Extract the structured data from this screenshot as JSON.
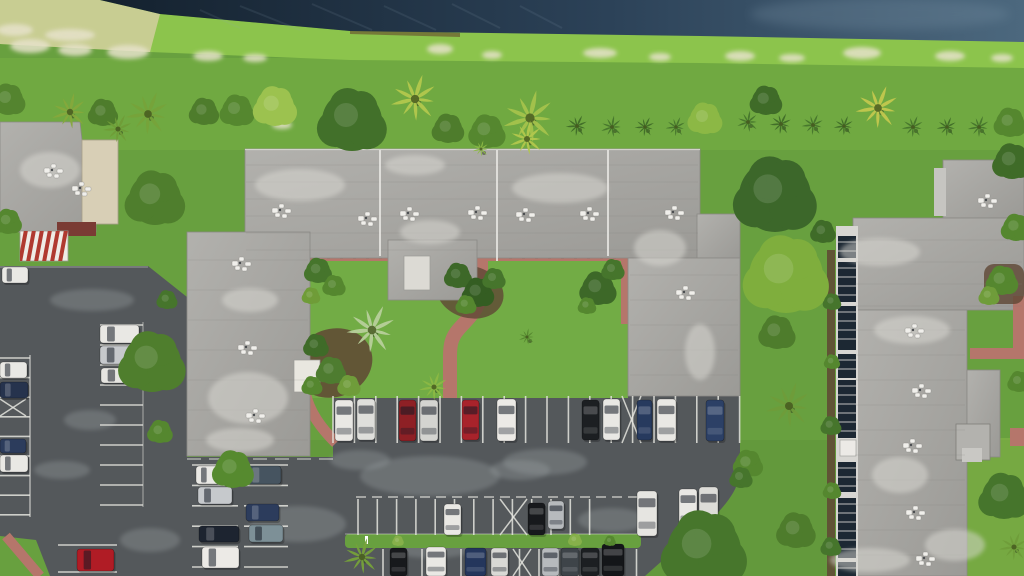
{
  "meta": {
    "description": "Aerial drone view of a condominium complex: flat gray roofs around a landscaped central courtyard with salmon-red concrete walkways, parking lots with parked cars, mowed lawns with rows of palms and shrubs, a bright grassy canal bank and a dark blue-gray canal across the top."
  },
  "palette": {
    "grass": "#68a03f",
    "grass_bright": "#8cc44c",
    "grass_dark": "#4e7c30",
    "grass_pale": "#c8cd92",
    "sand": "#e6e2ca",
    "water_dark": "#14212e",
    "water_mid": "#2c4258",
    "water_light": "#4c687e",
    "roof": "#a8a7a3",
    "roof_light": "#c6c5c1",
    "roof_edge": "#878682",
    "beige_roof": "#d8cfb6",
    "maroon": "#7a3b34",
    "awning_white": "#efece6",
    "awning_red": "#b03a30",
    "asphalt": "#54585b",
    "asphalt_light": "#9aa0a2",
    "stall_line": "#e4e4de",
    "path_red": "#b5766b",
    "mulch": "#5f4734",
    "glass": "#1c2833",
    "walk_white": "#d7d6d2",
    "white_unit": "#f0efeb"
  },
  "water_streaks": [
    [
      240,
      6,
      300,
      30
    ],
    [
      312,
      4,
      372,
      30
    ],
    [
      384,
      6,
      436,
      30
    ],
    [
      452,
      4,
      500,
      28
    ],
    [
      520,
      6,
      562,
      28
    ],
    [
      200,
      10,
      240,
      28
    ]
  ],
  "sand": [
    [
      30,
      46,
      20,
      7
    ],
    [
      75,
      50,
      17,
      6
    ],
    [
      128,
      52,
      21,
      7
    ],
    [
      208,
      56,
      15,
      5
    ],
    [
      255,
      58,
      12,
      4
    ],
    [
      440,
      49,
      13,
      5
    ],
    [
      492,
      55,
      10,
      4
    ],
    [
      600,
      53,
      17,
      5
    ],
    [
      660,
      57,
      11,
      4
    ],
    [
      740,
      56,
      15,
      5
    ],
    [
      792,
      58,
      13,
      4
    ],
    [
      862,
      53,
      19,
      6
    ],
    [
      950,
      56,
      15,
      5
    ],
    [
      1002,
      58,
      11,
      4
    ],
    [
      282,
      125,
      10,
      4
    ],
    [
      70,
      35,
      25,
      6
    ],
    [
      15,
      30,
      18,
      6
    ]
  ],
  "roof_patches": [
    [
      300,
      185,
      45,
      16
    ],
    [
      560,
      188,
      48,
      15
    ],
    [
      430,
      232,
      30,
      12
    ],
    [
      660,
      248,
      26,
      18
    ],
    [
      250,
      300,
      28,
      12
    ],
    [
      248,
      398,
      40,
      26
    ],
    [
      240,
      440,
      34,
      12
    ],
    [
      700,
      352,
      15,
      28
    ],
    [
      415,
      165,
      30,
      10
    ],
    [
      880,
      252,
      40,
      14
    ],
    [
      900,
      475,
      28,
      18
    ],
    [
      912,
      330,
      38,
      14
    ],
    [
      955,
      545,
      30,
      16
    ],
    [
      50,
      170,
      30,
      18
    ],
    [
      870,
      560,
      40,
      12
    ]
  ],
  "asphalt_patches": [
    [
      430,
      476,
      70,
      20
    ],
    [
      545,
      462,
      42,
      13
    ],
    [
      298,
      524,
      48,
      18
    ],
    [
      612,
      520,
      34,
      12
    ],
    [
      245,
      308,
      24,
      9
    ],
    [
      92,
      300,
      42,
      11
    ],
    [
      62,
      470,
      28,
      9
    ],
    [
      432,
      549,
      40,
      9
    ],
    [
      520,
      470,
      30,
      10
    ],
    [
      360,
      460,
      30,
      10
    ],
    [
      150,
      540,
      30,
      12
    ],
    [
      90,
      420,
      26,
      10
    ]
  ],
  "ac_units": [
    [
      272,
      208
    ],
    [
      358,
      216
    ],
    [
      400,
      211
    ],
    [
      468,
      210
    ],
    [
      516,
      212
    ],
    [
      580,
      211
    ],
    [
      665,
      210
    ],
    [
      232,
      261
    ],
    [
      238,
      345
    ],
    [
      246,
      413
    ],
    [
      676,
      290
    ],
    [
      905,
      328
    ],
    [
      912,
      388
    ],
    [
      903,
      443
    ],
    [
      906,
      510
    ],
    [
      978,
      198
    ],
    [
      916,
      556
    ],
    [
      44,
      168
    ],
    [
      72,
      186
    ]
  ],
  "pipes": [
    [
      380,
      150,
      380,
      256
    ],
    [
      497,
      150,
      497,
      261
    ],
    [
      608,
      150,
      608,
      256
    ]
  ],
  "stall_groups": [
    {
      "d": "v",
      "x": 333,
      "y": 396,
      "len": 47,
      "n": 20,
      "g": 21.4
    },
    {
      "d": "v",
      "x": 358,
      "y": 499,
      "len": 36,
      "n": 13,
      "g": 19.3
    },
    {
      "d": "v",
      "x": 383,
      "y": 549,
      "len": 27,
      "n": 14,
      "g": 19.5
    },
    {
      "d": "h",
      "x": 0,
      "len": 30,
      "y": 358,
      "n": 9,
      "g": 19.6
    },
    {
      "d": "h",
      "x": 100,
      "len": 43,
      "y": 325,
      "n": 10,
      "g": 20
    },
    {
      "d": "h",
      "x": 192,
      "len": 46,
      "y": 465,
      "n": 6,
      "g": 20.4
    },
    {
      "d": "h",
      "x": 244,
      "len": 44,
      "y": 465,
      "n": 6,
      "g": 20.4
    },
    {
      "d": "h",
      "x": 58,
      "len": 59,
      "y": 545,
      "n": 2,
      "g": 27
    }
  ],
  "dash_lines": [
    {
      "x1": 356,
      "y1": 497,
      "x2": 640,
      "y2": 497,
      "dash": "10 6",
      "w": 1.5,
      "o": 0.75
    },
    {
      "x1": 187,
      "y1": 459,
      "x2": 333,
      "y2": 459,
      "dash": "14 8",
      "w": 1.5,
      "o": 0.6
    },
    {
      "x1": 345,
      "y1": 534,
      "x2": 641,
      "y2": 534,
      "dash": "",
      "w": 1,
      "o": 0.5
    },
    {
      "x1": 30,
      "y1": 355,
      "x2": 30,
      "y2": 517,
      "dash": "",
      "w": 1.4,
      "o": 0.7
    },
    {
      "x1": 143,
      "y1": 322,
      "x2": 143,
      "y2": 507,
      "dash": "",
      "w": 1.2,
      "o": 0.5
    },
    {
      "x1": 0,
      "y1": 267,
      "x2": 148,
      "y2": 267,
      "dash": "",
      "w": 1.2,
      "o": 0.4
    }
  ],
  "x_stalls": [
    [
      622,
      396,
      19,
      47
    ],
    [
      500,
      499,
      27,
      36
    ],
    [
      513,
      549,
      18,
      27
    ],
    [
      0,
      399,
      26,
      17
    ]
  ],
  "glass_segments": [
    [
      236,
      22
    ],
    [
      262,
      40
    ],
    [
      306,
      44
    ],
    [
      354,
      24
    ],
    [
      380,
      58
    ],
    [
      462,
      30
    ],
    [
      498,
      60
    ],
    [
      562,
      14
    ]
  ],
  "cars": [
    [
      335,
      400,
      18,
      41,
      "#e9e8e4"
    ],
    [
      357,
      399,
      18,
      41,
      "#dfdfdb"
    ],
    [
      399,
      400,
      17,
      41,
      "#8e2025"
    ],
    [
      420,
      400,
      18,
      41,
      "#d4d4d0"
    ],
    [
      462,
      400,
      17,
      40,
      "#a8232b"
    ],
    [
      497,
      399,
      19,
      42,
      "#eceae6"
    ],
    [
      582,
      400,
      17,
      40,
      "#1c1f22"
    ],
    [
      603,
      399,
      17,
      41,
      "#e9e8e4"
    ],
    [
      637,
      400,
      15,
      40,
      "#273a5e"
    ],
    [
      657,
      399,
      19,
      42,
      "#e9e8e4"
    ],
    [
      706,
      400,
      18,
      41,
      "#2c4066"
    ],
    [
      444,
      504,
      17,
      31,
      "#e9e8e4"
    ],
    [
      528,
      503,
      17,
      32,
      "#17191c"
    ],
    [
      548,
      501,
      16,
      28,
      "#b7babd"
    ],
    [
      637,
      491,
      20,
      45,
      "#e6e5e1"
    ],
    [
      679,
      489,
      18,
      39,
      "#e9e8e4"
    ],
    [
      699,
      487,
      19,
      43,
      "#dddcd8"
    ],
    [
      390,
      548,
      17,
      28,
      "#17191c"
    ],
    [
      426,
      547,
      20,
      29,
      "#e9e8e4"
    ],
    [
      465,
      548,
      21,
      28,
      "#24365c"
    ],
    [
      491,
      548,
      17,
      28,
      "#d9d9d5"
    ],
    [
      542,
      548,
      17,
      28,
      "#b7babd"
    ],
    [
      561,
      548,
      18,
      28,
      "#3e4449"
    ],
    [
      581,
      548,
      18,
      28,
      "#1c1f22"
    ],
    [
      602,
      544,
      22,
      32,
      "#141619"
    ],
    [
      0,
      362,
      27,
      16,
      "#e9e8e4"
    ],
    [
      0,
      382,
      28,
      16,
      "#26334d"
    ],
    [
      0,
      439,
      26,
      14,
      "#2c3c5c"
    ],
    [
      0,
      455,
      28,
      17,
      "#e9e8e4"
    ],
    [
      100,
      325,
      39,
      18,
      "#e9e8e4"
    ],
    [
      100,
      346,
      38,
      18,
      "#c6c9cc"
    ],
    [
      101,
      368,
      37,
      15,
      "#e6e5e1"
    ],
    [
      2,
      267,
      26,
      16,
      "#e9e8e4"
    ],
    [
      196,
      466,
      28,
      18,
      "#e9e8e4"
    ],
    [
      246,
      466,
      35,
      18,
      "#465460"
    ],
    [
      198,
      487,
      34,
      17,
      "#c6c9cc"
    ],
    [
      246,
      504,
      33,
      17,
      "#2c3c5c"
    ],
    [
      199,
      526,
      40,
      16,
      "#1d2430"
    ],
    [
      249,
      525,
      34,
      17,
      "#7d9097"
    ],
    [
      202,
      547,
      37,
      21,
      "#eceae6"
    ],
    [
      77,
      549,
      37,
      22,
      "#b01c25"
    ]
  ],
  "trees": [
    [
      8,
      100,
      15,
      "#54842f",
      "bush"
    ],
    [
      70,
      112,
      20,
      "#85a83c",
      "palm"
    ],
    [
      103,
      113,
      13,
      "#4e7c2c",
      "bush"
    ],
    [
      148,
      114,
      24,
      "#76a23a",
      "palm"
    ],
    [
      204,
      112,
      13,
      "#4e7c2c",
      "bush"
    ],
    [
      237,
      111,
      15,
      "#55872f",
      "bush"
    ],
    [
      275,
      107,
      19,
      "#9cc24f",
      "bush"
    ],
    [
      352,
      121,
      30,
      "#42702a",
      "tree"
    ],
    [
      415,
      99,
      26,
      "#b2c74d",
      "palm"
    ],
    [
      448,
      129,
      14,
      "#4e7c2c",
      "bush"
    ],
    [
      487,
      132,
      16,
      "#55872f",
      "bush"
    ],
    [
      530,
      118,
      29,
      "#a4c24c",
      "palm"
    ],
    [
      577,
      126,
      12,
      "#3f6b28",
      "palm"
    ],
    [
      612,
      127,
      12,
      "#46752c",
      "palm"
    ],
    [
      645,
      127,
      11,
      "#3f6b28",
      "palm"
    ],
    [
      676,
      127,
      11,
      "#46752c",
      "palm"
    ],
    [
      705,
      119,
      15,
      "#8cb845",
      "bush"
    ],
    [
      766,
      101,
      14,
      "#3f6b28",
      "bush"
    ],
    [
      748,
      122,
      12,
      "#46752c",
      "palm"
    ],
    [
      781,
      124,
      12,
      "#3f6b28",
      "palm"
    ],
    [
      813,
      125,
      12,
      "#46752c",
      "palm"
    ],
    [
      844,
      126,
      11,
      "#3f6b28",
      "palm"
    ],
    [
      878,
      108,
      24,
      "#c2c74e",
      "palm"
    ],
    [
      913,
      127,
      12,
      "#46752c",
      "palm"
    ],
    [
      947,
      127,
      11,
      "#3f6b28",
      "palm"
    ],
    [
      979,
      127,
      12,
      "#46752c",
      "palm"
    ],
    [
      1010,
      123,
      14,
      "#55872f",
      "bush"
    ],
    [
      155,
      199,
      26,
      "#4f7e2d",
      "bush"
    ],
    [
      8,
      222,
      12,
      "#55872f",
      "bush"
    ],
    [
      118,
      129,
      16,
      "#6f9c38",
      "palm"
    ],
    [
      527,
      139,
      19,
      "#b2c74d",
      "palm"
    ],
    [
      481,
      149,
      9,
      "#8cb845",
      "palm"
    ],
    [
      775,
      196,
      36,
      "#3c672a",
      "tree"
    ],
    [
      786,
      276,
      37,
      "#7fae3d",
      "tree"
    ],
    [
      777,
      333,
      16,
      "#4e7c2c",
      "bush"
    ],
    [
      789,
      406,
      25,
      "#6f9c3a",
      "palm"
    ],
    [
      748,
      464,
      13,
      "#55872f",
      "bush"
    ],
    [
      741,
      478,
      10,
      "#46752c",
      "bush"
    ],
    [
      796,
      531,
      17,
      "#4e7c2c",
      "bush"
    ],
    [
      704,
      551,
      37,
      "#47762c",
      "tree"
    ],
    [
      1012,
      162,
      17,
      "#3f6b28",
      "bush"
    ],
    [
      1016,
      228,
      13,
      "#55872f",
      "bush"
    ],
    [
      1004,
      497,
      22,
      "#46752c",
      "bush"
    ],
    [
      1014,
      547,
      16,
      "#6f9c3a",
      "palm"
    ],
    [
      1019,
      382,
      10,
      "#55872f",
      "bush"
    ],
    [
      1002,
      281,
      14,
      "#55872f",
      "bush"
    ],
    [
      989,
      296,
      9,
      "#6f9c3a",
      "bush"
    ],
    [
      823,
      232,
      11,
      "#3f6b28",
      "bush"
    ],
    [
      832,
      302,
      8,
      "#46752c",
      "bush"
    ],
    [
      832,
      362,
      7,
      "#55872f",
      "bush"
    ],
    [
      831,
      426,
      9,
      "#46752c",
      "bush"
    ],
    [
      832,
      491,
      8,
      "#55872f",
      "bush"
    ],
    [
      831,
      547,
      9,
      "#46752c",
      "bush"
    ],
    [
      372,
      330,
      27,
      "#b7cf9b",
      "palm"
    ],
    [
      434,
      387,
      16,
      "#8cb845",
      "palm"
    ],
    [
      318,
      271,
      12,
      "#46752c",
      "bush"
    ],
    [
      334,
      286,
      10,
      "#55872f",
      "bush"
    ],
    [
      311,
      296,
      8,
      "#6f9c38",
      "bush"
    ],
    [
      316,
      346,
      11,
      "#3f6b28",
      "bush"
    ],
    [
      331,
      371,
      13,
      "#4e7c30",
      "bush"
    ],
    [
      349,
      386,
      10,
      "#6f9c3a",
      "bush"
    ],
    [
      312,
      386,
      9,
      "#55872f",
      "bush"
    ],
    [
      458,
      276,
      12,
      "#3d6828",
      "bush"
    ],
    [
      478,
      293,
      14,
      "#345d22",
      "bush"
    ],
    [
      494,
      279,
      10,
      "#46752c",
      "bush"
    ],
    [
      466,
      305,
      9,
      "#55872f",
      "bush"
    ],
    [
      598,
      289,
      16,
      "#3d6828",
      "bush"
    ],
    [
      613,
      270,
      10,
      "#46752c",
      "bush"
    ],
    [
      587,
      306,
      8,
      "#55872f",
      "bush"
    ],
    [
      527,
      337,
      9,
      "#55872f",
      "palm"
    ],
    [
      362,
      557,
      20,
      "#76a23a",
      "palm"
    ],
    [
      398,
      541,
      5,
      "#86b04a",
      "bush"
    ],
    [
      575,
      540,
      6,
      "#86b04a",
      "bush"
    ],
    [
      610,
      541,
      5,
      "#55872f",
      "bush"
    ],
    [
      233,
      470,
      18,
      "#568a2f",
      "bush"
    ],
    [
      152,
      363,
      29,
      "#4f7e2d",
      "bush"
    ],
    [
      160,
      432,
      11,
      "#55872f",
      "bush"
    ],
    [
      167,
      300,
      9,
      "#46752c",
      "bush"
    ]
  ]
}
